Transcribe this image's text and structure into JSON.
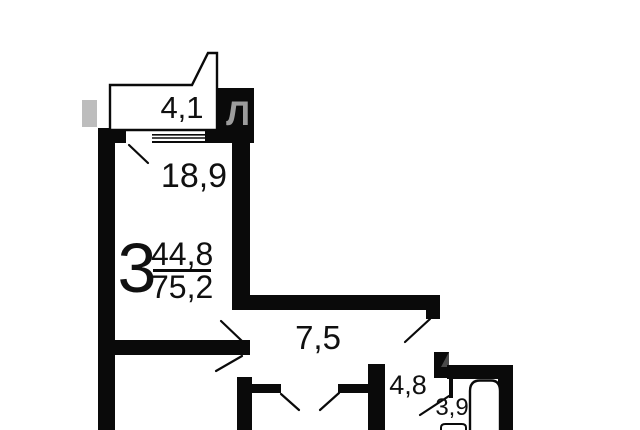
{
  "floor_plan": {
    "apartment": {
      "number_of_rooms": "3",
      "living_area": "44,8",
      "total_area": "75,2"
    },
    "areas": {
      "balcony": "4,1",
      "living_room": "18,9",
      "corridor": "7,5",
      "hallway": "4,8",
      "bathroom": "3,9"
    },
    "watermark": {
      "letter": "Л"
    },
    "colors": {
      "wall": "#0a0a0a",
      "background": "#ffffff",
      "watermark_light": "#bdbdbd",
      "watermark_mid": "#9c9c9c",
      "watermark_dark": "#4a4a4a"
    },
    "symbols": [
      "bathtub",
      "sink",
      "window",
      "door-swing"
    ]
  }
}
